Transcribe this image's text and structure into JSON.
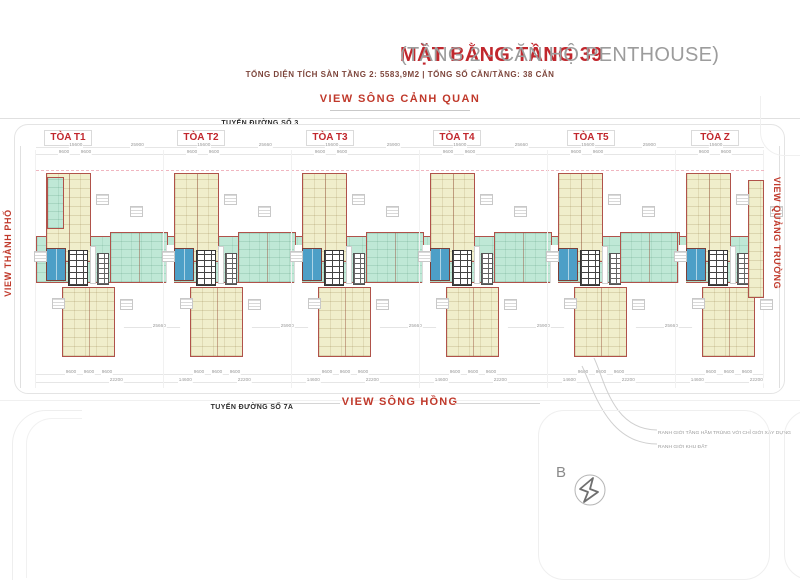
{
  "header": {
    "title_red": "MẶT BẰNG TẦNG 39",
    "title_gray": "(TẦNG 2 - CĂN HỘ PENTHOUSE)",
    "subtitle": "TỔNG DIỆN TÍCH SÀN TẦNG 2: 5583,9M2 | TỔNG SỐ CĂN/TẦNG: 38 CĂN"
  },
  "views": {
    "top": "VIEW SÔNG CẢNH QUAN",
    "left": "VIEW THÀNH PHỐ",
    "right": "VIEW QUẢNG TRƯỜNG",
    "bottom": "VIEW SÔNG HỒNG"
  },
  "streets": {
    "top": "TUYẾN ĐƯỜNG SỐ 3",
    "bottom": "TUYẾN ĐƯỜNG SỐ 7A"
  },
  "towers": [
    {
      "label": "TÒA T1"
    },
    {
      "label": "TÒA T2"
    },
    {
      "label": "TÒA T3"
    },
    {
      "label": "TÒA T4"
    },
    {
      "label": "TÒA T5"
    },
    {
      "label": "TÒA Z"
    }
  ],
  "legend": {
    "items": [
      "RANH GIỚI TẦNG HẦM TRÙNG VỚI CHỈ GIỚI XÂY DỰNG",
      "RANH GIỚI KHU ĐẤT"
    ]
  },
  "compass": {
    "north_label": "B"
  },
  "dims": {
    "n9600": "9600",
    "top_a": [
      "15600",
      "15600",
      "15600",
      "15600",
      "15600",
      "15600"
    ],
    "top_b": [
      "25900",
      "25660",
      "25900",
      "25660",
      "25900",
      ""
    ],
    "total": [
      "22200",
      "22200",
      "22200",
      "22200",
      "22200",
      "22200"
    ],
    "gap": [
      "14600",
      "14600",
      "14600",
      "14600",
      "14600",
      ""
    ],
    "mid": [
      "25660",
      "25900",
      "25660",
      "25900",
      "25660",
      ""
    ]
  },
  "colors": {
    "accent_red": "#c1272d",
    "title_gray": "#9c9c9c",
    "subtitle_maroon": "#7d453b",
    "unit_yellow": "#f0eecb",
    "unit_teal": "#bfe8d6",
    "unit_blue": "#4d9fc7",
    "outline_red": "#b0524a",
    "basement_boundary_pink": "#f0b6c0"
  }
}
